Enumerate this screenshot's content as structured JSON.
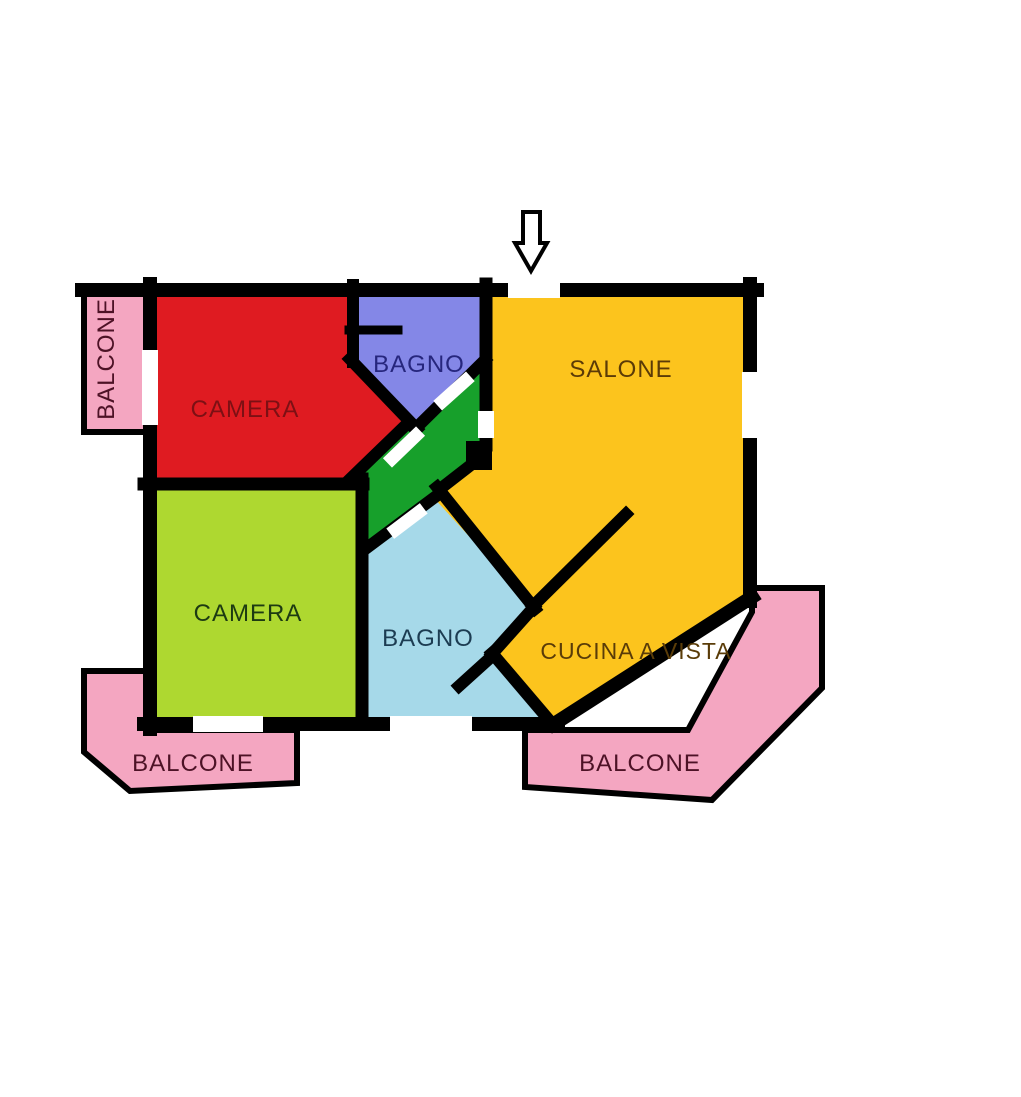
{
  "plan": {
    "background": "#ffffff",
    "wall_color": "#000000",
    "opening_color": "#ffffff",
    "entrance": {
      "icon": "down-arrow-icon"
    },
    "rooms": {
      "camera_nord": {
        "label": "CAMERA",
        "fill": "#df1b21",
        "label_color": "#7d1014"
      },
      "bagno_nord": {
        "label": "BAGNO",
        "fill": "#8487e7",
        "label_color": "#26267d"
      },
      "salone": {
        "label": "SALONE",
        "fill": "#fcc41d",
        "label_color": "#5b3b07"
      },
      "corridoio": {
        "fill": "#17a02b"
      },
      "camera_sud": {
        "label": "CAMERA",
        "fill": "#aed830",
        "label_color": "#1d3a12"
      },
      "bagno_sud": {
        "label": "BAGNO",
        "fill": "#a6d9e9",
        "label_color": "#1c3c52"
      },
      "cucina": {
        "label": "CUCINA A VISTA",
        "label_color": "#5a3c08"
      },
      "balcone_ovest": {
        "label": "BALCONE",
        "fill": "#f4a6c1",
        "label_color": "#4d1226"
      },
      "balcone_sud_ovest": {
        "label": "BALCONE",
        "fill": "#f4a6c1",
        "label_color": "#4d1226"
      },
      "balcone_sud_est": {
        "label": "BALCONE",
        "fill": "#f4a6c1",
        "label_color": "#4d1226"
      }
    }
  }
}
